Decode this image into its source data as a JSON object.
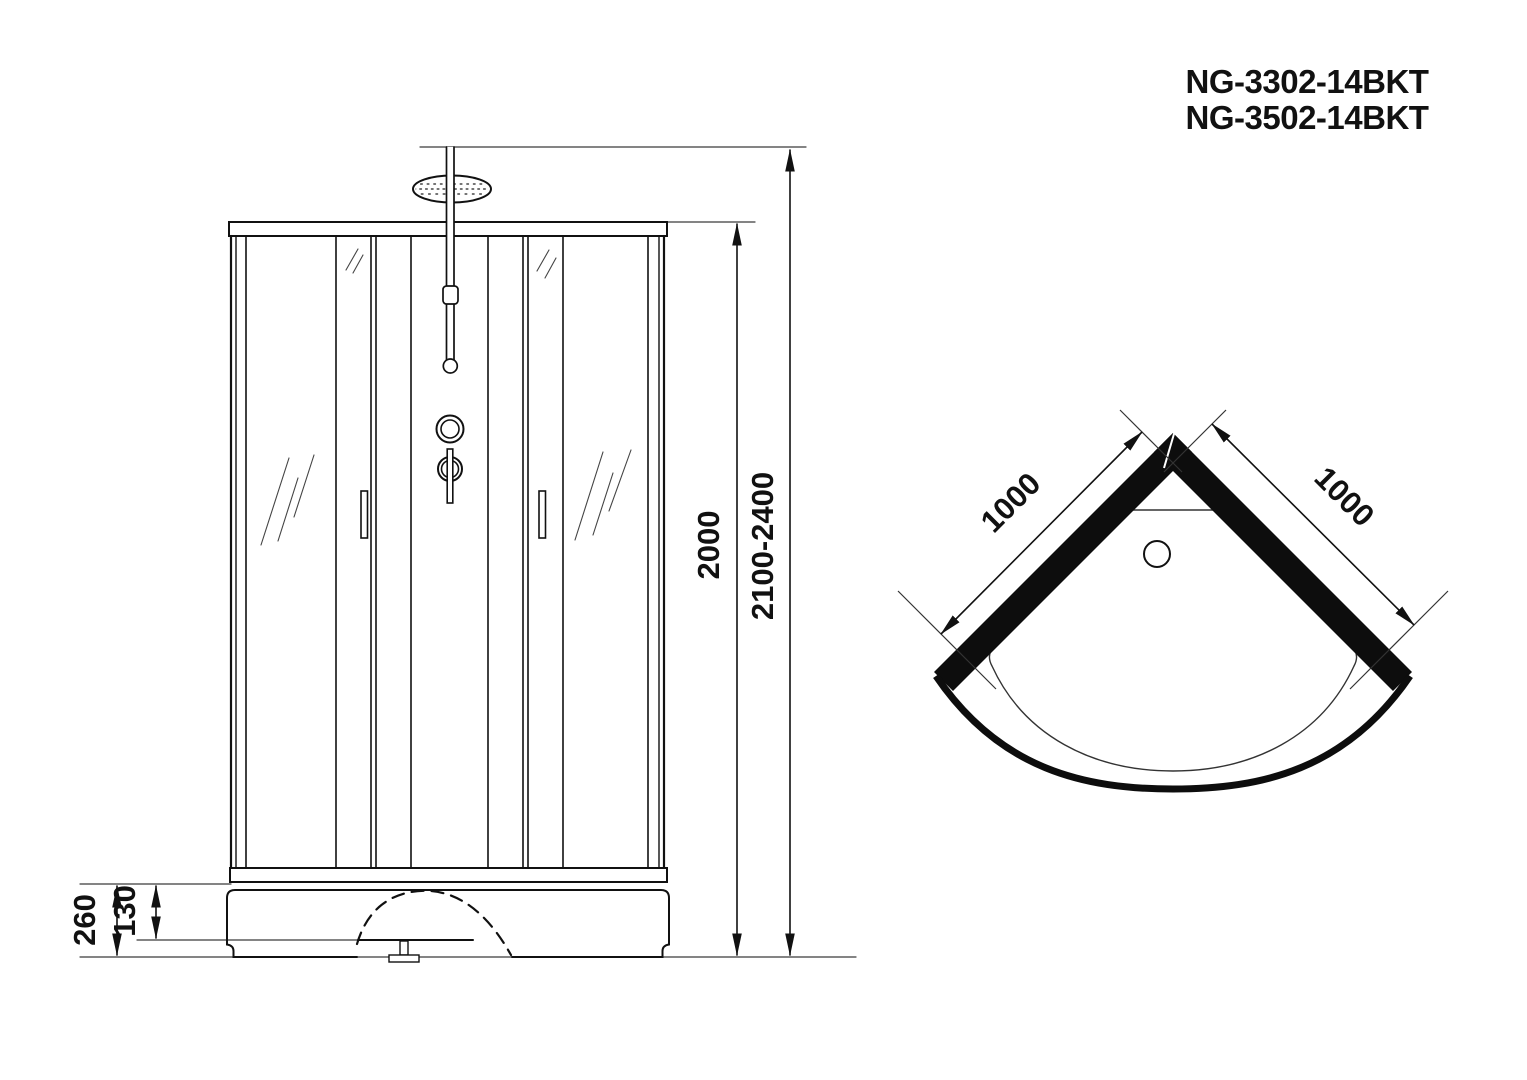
{
  "header": {
    "models": [
      {
        "label": "NG-3302-14BKT"
      },
      {
        "label": "NG-3502-14BKT"
      }
    ]
  },
  "front_view": {
    "dims": {
      "inner_height": "2000",
      "overall_height": "2100-2400",
      "base_height": "260",
      "base_step": "130"
    }
  },
  "top_view": {
    "dims": {
      "left_side": "1000",
      "right_side": "1000"
    }
  },
  "colors": {
    "line": "#1a1a1a",
    "thin_line": "#333333",
    "solid_fill": "#0d0d0d",
    "background": "#ffffff"
  }
}
